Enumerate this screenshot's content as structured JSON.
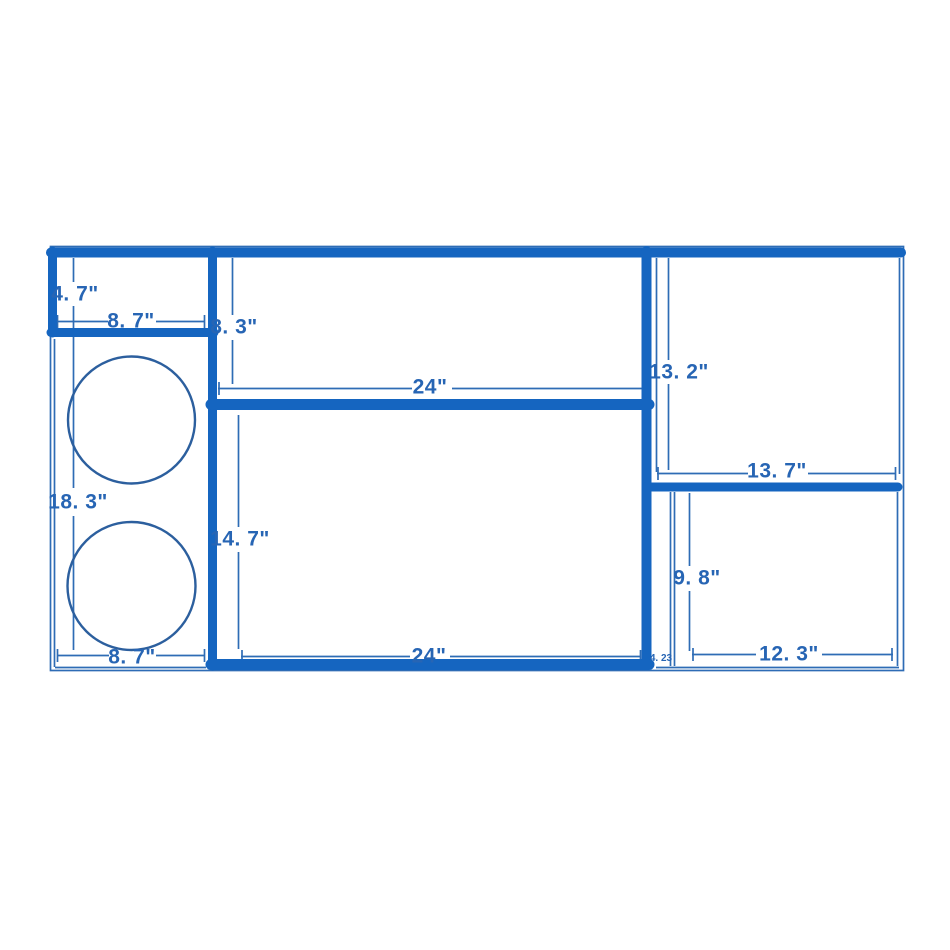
{
  "diagram": {
    "type": "dimensioned-drawing",
    "units": "inches",
    "colors": {
      "bg": "#ffffff",
      "wall": "#1565c0",
      "line": "#2e6cb5",
      "text": "#2765b4",
      "circle": "#2c5f9e"
    },
    "labels": {
      "dim_4_7": "4. 7\"",
      "dim_8_7_top": "8. 7\"",
      "dim_8_3": "8. 3\"",
      "dim_24_top": "24\"",
      "dim_13_2": "13. 2\"",
      "dim_13_7": "13. 7\"",
      "dim_18_3": "18. 3\"",
      "dim_14_7": "14. 7\"",
      "dim_9_8": "9. 8\"",
      "dim_8_7_bottom": "8. 7\"",
      "dim_24_bottom": "24\"",
      "dim_12_3": "12. 3\"",
      "dim_4_23": "4. 23"
    },
    "compartments": [
      {
        "id": "top-left-box",
        "width_label": "8. 7\"",
        "height_label": "4. 7\""
      },
      {
        "id": "left-column",
        "width_label": "8. 7\"",
        "height_label": "18. 3\"",
        "circle_cutouts": 2
      },
      {
        "id": "top-center-box",
        "width_label": "24\"",
        "height_label": "8. 3\""
      },
      {
        "id": "bottom-center-box",
        "width_label": "24\"",
        "height_label": "14. 7\""
      },
      {
        "id": "top-right-box",
        "width_label": "13. 7\"",
        "height_label": "13. 2\""
      },
      {
        "id": "bottom-right-box",
        "width_label": "12. 3\"",
        "height_label": "9. 8\"",
        "corner_label": "4. 23"
      }
    ]
  }
}
